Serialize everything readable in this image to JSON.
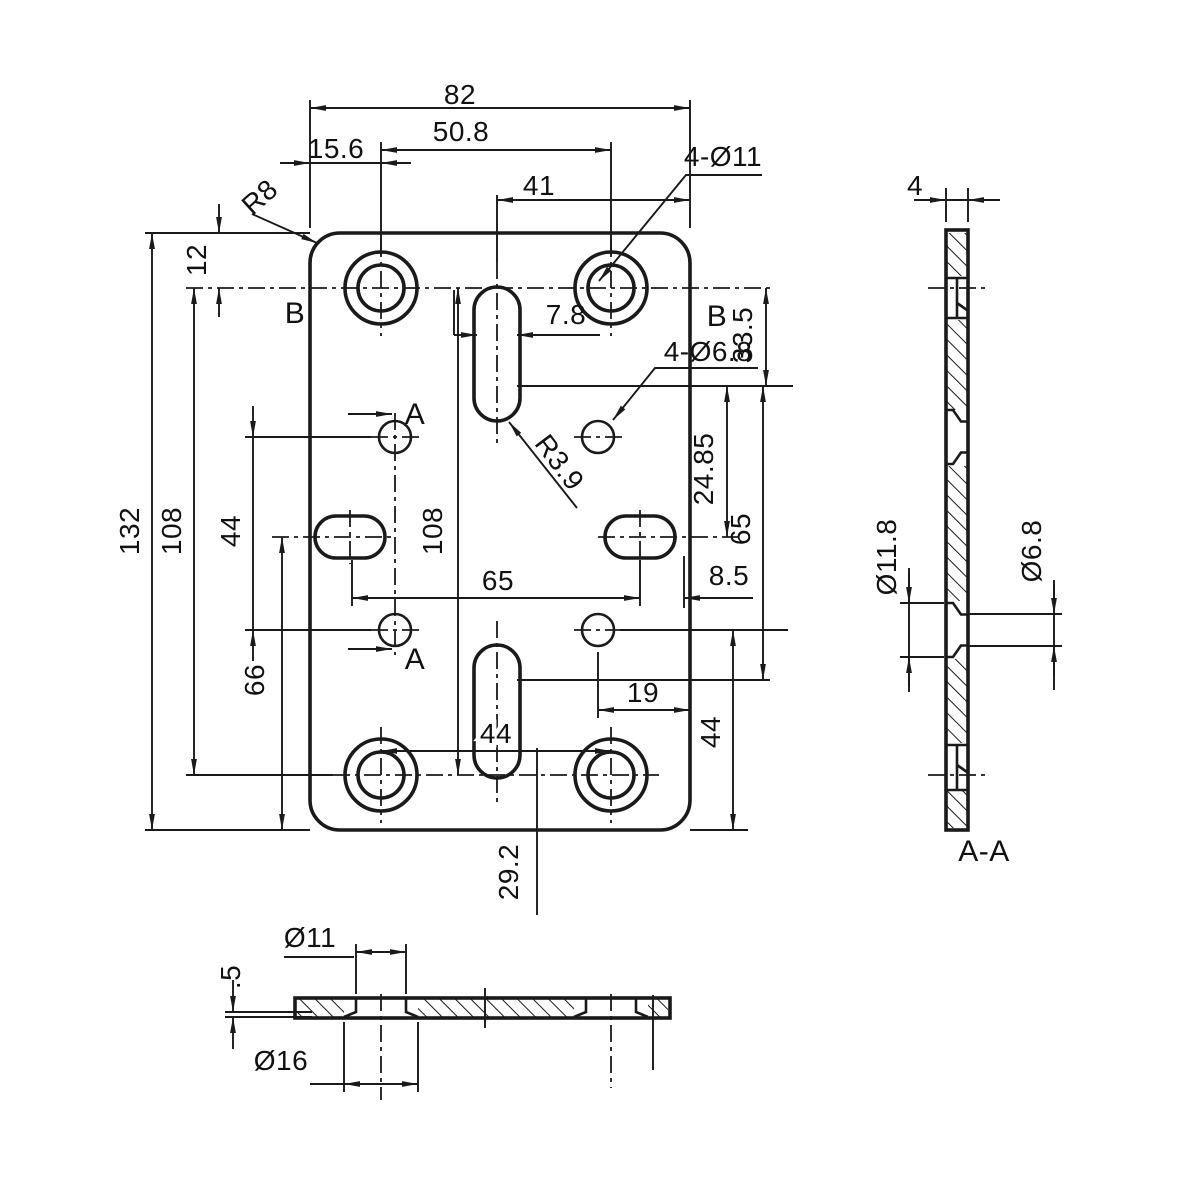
{
  "drawing": {
    "ink_color": "#1a1a1a",
    "paper_color": "#ffffff",
    "front": {
      "dim_overall_width": "82",
      "dim_hole_span": "50.8",
      "dim_edge_to_hole": "15.6",
      "dim_slot_to_edge": "41",
      "label_big_holes": "4-Ø11",
      "label_corner_radius": "R8",
      "dim_top_offset": "12",
      "label_b_left": "B",
      "label_b_right": "B",
      "dim_33_5": "33.5",
      "dim_slot_width": "7.8",
      "label_small_holes": "4-Ø6.8",
      "label_slot_radius": "R3.9",
      "dim_overall_height": "132",
      "dim_108_left": "108",
      "dim_108_mid": "108",
      "dim_44_left": "44",
      "dim_66": "66",
      "label_a_top": "A",
      "label_a_bottom": "A",
      "dim_24_85": "24.85",
      "dim_65_vert": "65",
      "dim_65_horiz": "65",
      "dim_8_5": "8.5",
      "dim_19": "19",
      "dim_44_bottom": "44",
      "dim_44_right": "44",
      "dim_29_2": "29.2"
    },
    "side": {
      "dim_thickness": "4",
      "dim_csk_outer": "Ø11.8",
      "dim_csk_inner": "Ø6.8",
      "label_section": "A-A"
    },
    "bottom": {
      "dim_hole": "Ø11",
      "dim_lip": ".5",
      "dim_counterbore": "Ø16"
    }
  }
}
